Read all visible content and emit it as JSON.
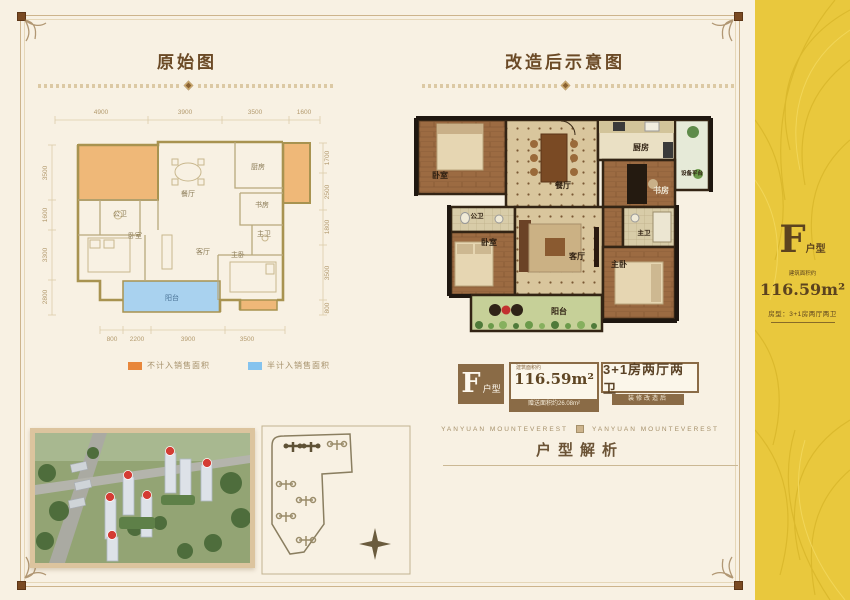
{
  "titles": {
    "left": "原始图",
    "right": "改造后示意图"
  },
  "original_plan": {
    "dims_top": [
      "4900",
      "3900",
      "3500",
      "1600"
    ],
    "dims_bottom": [
      "800",
      "2200",
      "3900",
      "3500"
    ],
    "dims_left": [
      "3500",
      "1600",
      "3300",
      "2800"
    ],
    "dims_right": [
      "1700",
      "2500",
      "1800",
      "3500",
      "800"
    ],
    "rooms": {
      "dining": "餐厅",
      "kitchen": "厨房",
      "study": "书房",
      "public_bath": "公卫",
      "bedroom": "卧室",
      "living": "客厅",
      "master": "主卧",
      "master_bath": "主卫",
      "balcony": "阳台"
    },
    "legend": [
      {
        "label": "不计入销售面积",
        "color": "#e8873b"
      },
      {
        "label": "半计入销售面积",
        "color": "#85c3ee"
      }
    ]
  },
  "renovated_plan": {
    "rooms": {
      "bedroom_top": "卧室",
      "dining": "餐厅",
      "kitchen": "厨房",
      "equipment": "设备平台",
      "study": "书房",
      "public_bath": "公卫",
      "bedroom_low": "卧室",
      "living": "客厅",
      "master_bath": "主卫",
      "master": "主卧",
      "balcony": "阳台"
    }
  },
  "badges": {
    "type_letter": "F",
    "type_suffix": "户型",
    "area_prefix": "建筑面积约",
    "area_value": "116.59m²",
    "area_bonus": "赠送面积约26.08m²",
    "layout": "3+1房两厅两卫",
    "layout_sub": "装修改造后"
  },
  "footer": {
    "brand_left": "YANYUAN MOUNTEVEREST",
    "brand_right": "YANYUAN MOUNTEVEREST",
    "analysis_title": "户型解析"
  },
  "sidebar": {
    "type_letter": "F",
    "type_suffix": "户型",
    "area_prefix": "建筑面积约",
    "area_value": "116.59m²",
    "detail": "房型：3+1房两厅两卫",
    "bg_color": "#e9c83d"
  }
}
